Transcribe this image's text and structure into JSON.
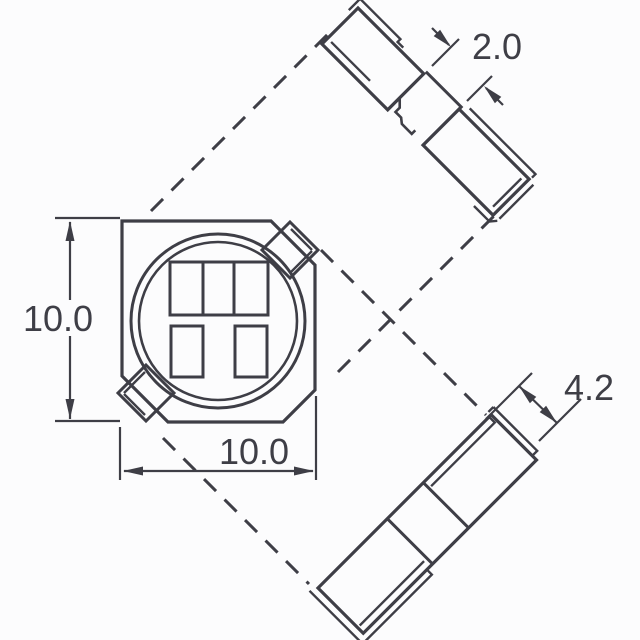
{
  "drawing": {
    "background_color": "#fcfcfd",
    "line_color": "#3e3e46",
    "dimensions": {
      "left_height": "10.0",
      "bottom_width": "10.0",
      "corner_tab": "2.0",
      "side_terminal": "4.2"
    }
  }
}
